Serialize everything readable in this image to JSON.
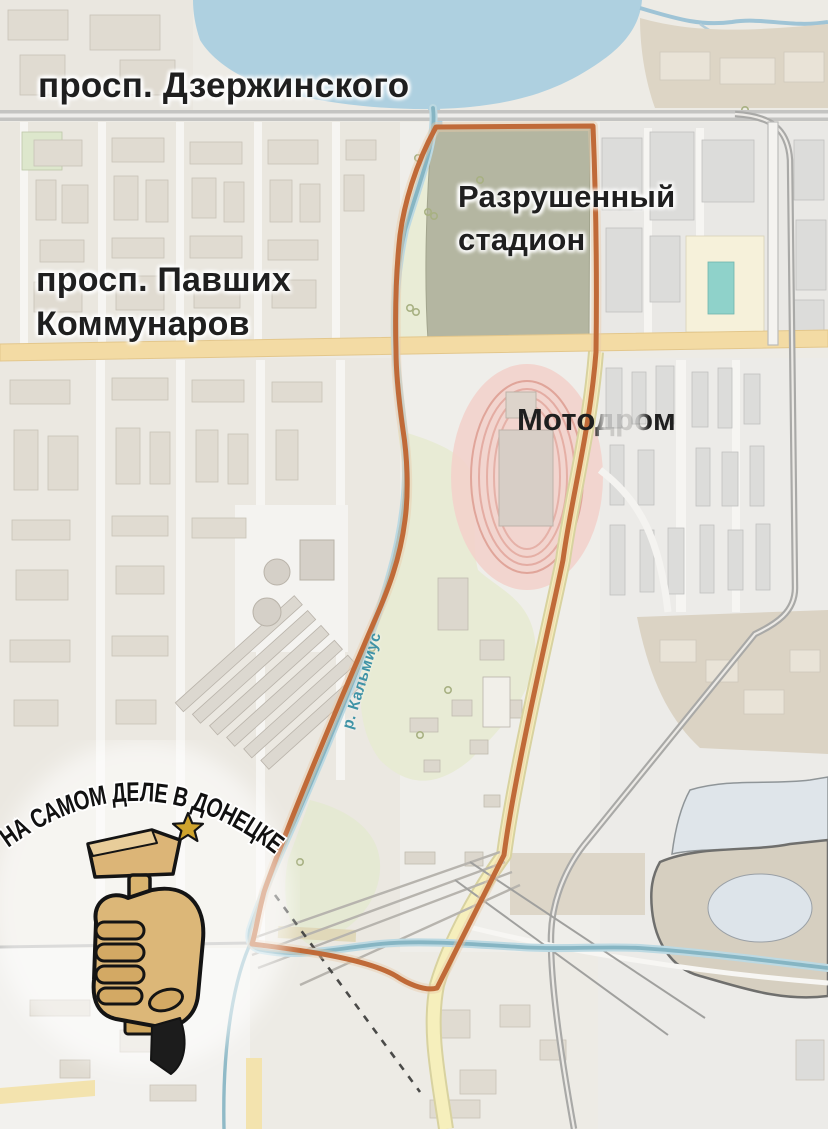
{
  "map": {
    "labels": {
      "street_top": "просп. Дзержинского",
      "street_left_line1": "просп. Павших",
      "street_left_line2": "Коммунаров",
      "stadium_line1": "Разрушенный",
      "stadium_line2": "стадион",
      "motodrome": "Мотодром",
      "river": "р. Кальмиус"
    },
    "watermark": {
      "text": "НА САМОМ ДЕЛЕ В ДОНЕЦКЕ"
    },
    "colors": {
      "highlight_outline": "#c06a38",
      "water": "#aed0e0",
      "river_line": "#7fb0c0",
      "road_yellow": "#f3dba4",
      "road_cream": "#f6efbc",
      "road_gray": "#a9a9a7",
      "stadium_fill": "#b4b6a1",
      "motodrome_fill": "#f2d2cb",
      "park_green": "#e7ead3",
      "label_text": "#1f1f1f",
      "river_label_text": "#3f93a6",
      "logo_gold": "#d9b36e",
      "logo_star": "#cfa42e"
    }
  }
}
